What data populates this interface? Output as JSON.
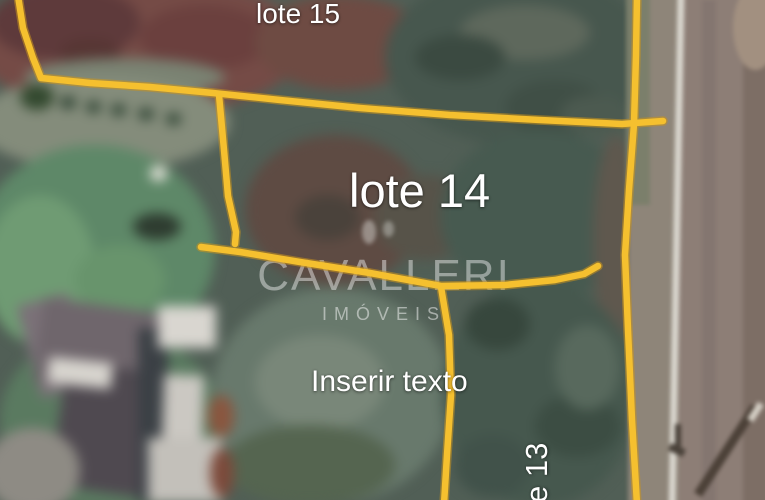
{
  "watermark": {
    "brand": "CAVALLERI",
    "tagline": "IMÓVEIS"
  },
  "labels": {
    "lot15": "lote 15",
    "lot14": "lote 14",
    "text_placeholder": "Inserir texto",
    "lot13_partial": "e 13"
  },
  "colors": {
    "boundary": "#F5C02F",
    "boundary_edge": "#C8931D",
    "label_text": "#FFFFFF"
  }
}
